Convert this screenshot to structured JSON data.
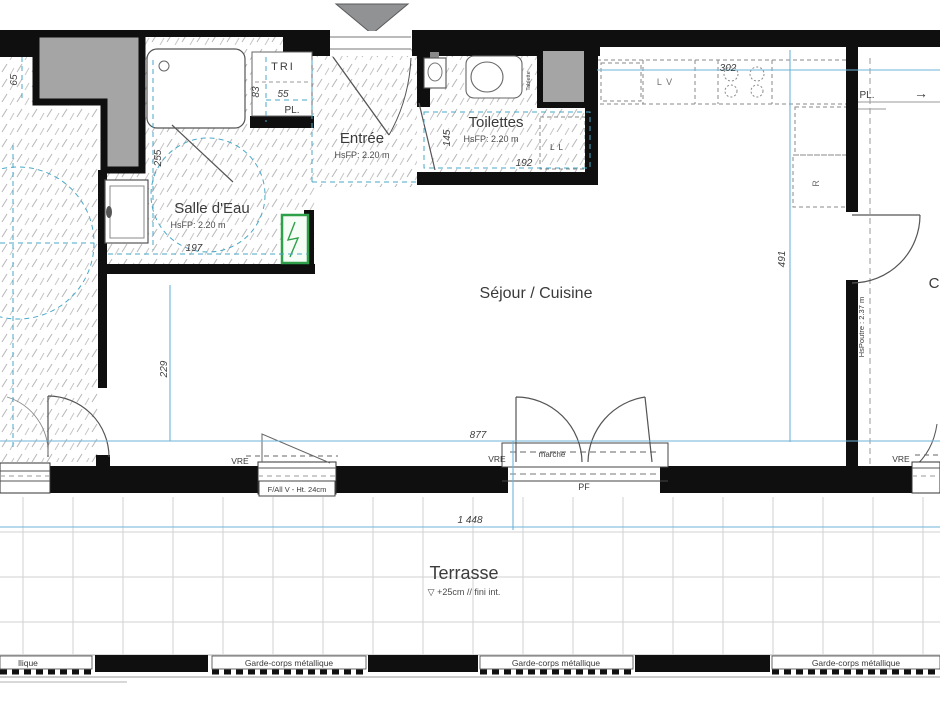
{
  "plan": {
    "rooms": {
      "salle_deau": {
        "label": "Salle d'Eau",
        "hsfp": "HsFP: 2.20 m"
      },
      "entree": {
        "label": "Entrée",
        "hsfp": "HsFP: 2.20 m"
      },
      "toilettes": {
        "label": "Toilettes",
        "hsfp": "HsFP: 2.20 m"
      },
      "sejour": {
        "label": "Séjour / Cuisine"
      },
      "terrasse": {
        "label": "Terrasse",
        "level": "▽ +25cm // fini int."
      },
      "chambre": {
        "label": "C"
      }
    },
    "dims": {
      "d65": "65",
      "d255": "255",
      "d83": "83",
      "d55": "55",
      "d197": "197",
      "d229": "229",
      "d145": "145",
      "d192": "192",
      "d302": "302",
      "d491": "491",
      "d877": "877",
      "d1448": "1 448"
    },
    "fixtures": {
      "tri": "TRI",
      "pl_entree": "PL.",
      "pl_right": "PL.",
      "arrow": "→",
      "lv": "L V",
      "fridge": "R",
      "ll": "L L",
      "tablette": "Tablette"
    },
    "openings": {
      "vre": "VRE",
      "pf": "PF",
      "marche": "marche",
      "fallv": "F/All V - Ht. 24cm",
      "hspoutre": "HsPoutre : 2.37 m"
    },
    "railing": {
      "label": "Garde-corps métallique",
      "partial_left": "llique"
    },
    "colors": {
      "wall": "#0f0f0f",
      "dim_blue": "#6db3d8",
      "teal_dash": "#49a8c9",
      "shaft_gray": "#a5a5a5",
      "triangle_gray": "#909294",
      "green_panel": "#2fa04a",
      "hatch": "#b8b8b8",
      "tile": "#d2d2d2"
    }
  }
}
